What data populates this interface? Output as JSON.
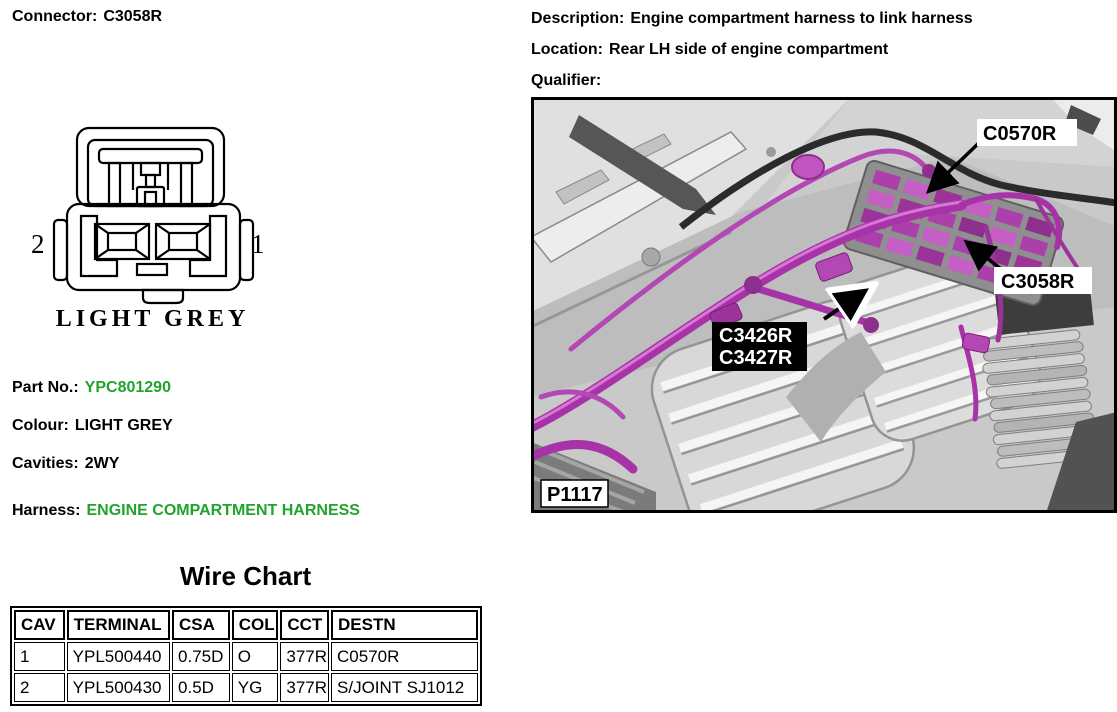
{
  "header": {
    "connector_label": "Connector:",
    "connector_value": "C3058R",
    "description_label": "Description:",
    "description_value": "Engine compartment harness to link harness",
    "location_label": "Location:",
    "location_value": "Rear LH side of engine compartment",
    "qualifier_label": "Qualifier:",
    "qualifier_value": ""
  },
  "diagram": {
    "pin_left": "2",
    "pin_right": "1",
    "caption": "LIGHT GREY"
  },
  "details": {
    "part_no_label": "Part No.:",
    "part_no_value": "YPC801290",
    "colour_label": "Colour:",
    "colour_value": "LIGHT GREY",
    "cavities_label": "Cavities:",
    "cavities_value": "2WY",
    "harness_label": "Harness:",
    "harness_value": "ENGINE COMPARTMENT HARNESS"
  },
  "photo": {
    "labels": {
      "c0570r": "C0570R",
      "c3058r": "C3058R",
      "c3426r": "C3426R",
      "c3427r": "C3427R",
      "p1117": "P1117"
    }
  },
  "wire_chart": {
    "title": "Wire Chart",
    "columns": [
      "CAV",
      "TERMINAL",
      "CSA",
      "COL",
      "CCT",
      "DESTN"
    ],
    "rows": [
      [
        "1",
        "YPL500440",
        "0.75D",
        "O",
        "377R",
        "C0570R"
      ],
      [
        "2",
        "YPL500430",
        "0.5D",
        "YG",
        "377R",
        "S/JOINT SJ1012"
      ]
    ]
  },
  "colors": {
    "accent_green": "#21a32c",
    "highlight_magenta": "#b13ab1"
  }
}
